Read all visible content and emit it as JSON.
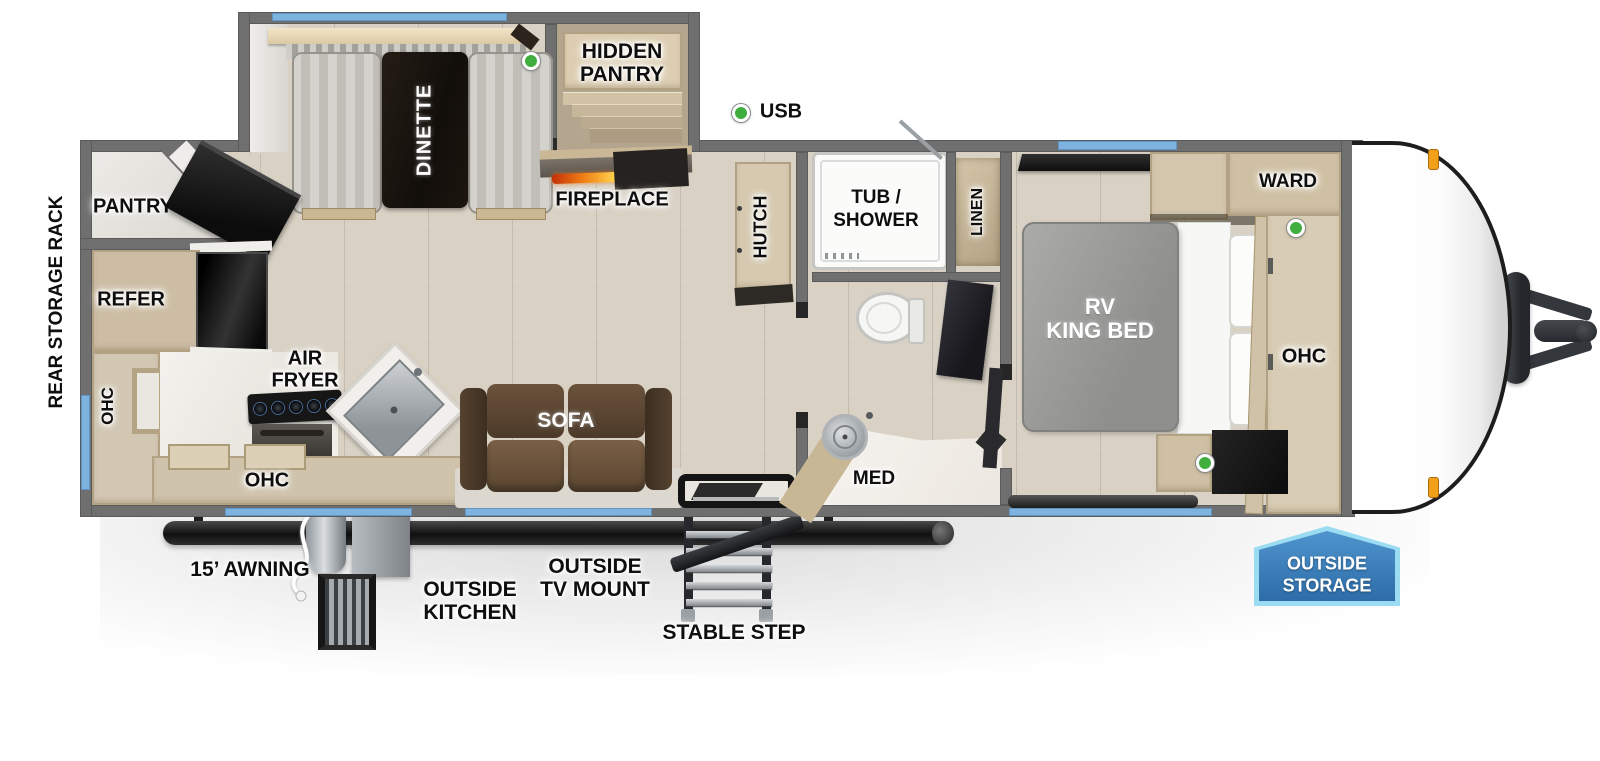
{
  "floorplan": {
    "interior_labels": {
      "hidden_pantry": [
        "HIDDEN",
        "PANTRY"
      ],
      "dinette": "DINETTE",
      "fireplace": "FIREPLACE",
      "pantry": "PANTRY",
      "refer": "REFER",
      "rear_storage_rack": "REAR STORAGE RACK",
      "ohc_rear": "OHC",
      "air_fryer": [
        "AIR",
        "FRYER"
      ],
      "ohc_kitchen": "OHC",
      "sofa": "SOFA",
      "hutch": "HUTCH",
      "tub_shower": [
        "TUB /",
        "SHOWER"
      ],
      "linen": "LINEN",
      "med": "MED",
      "rv_king_bed": [
        "RV",
        "KING BED"
      ],
      "ward": "WARD",
      "ohc_bedroom": "OHC"
    },
    "exterior_labels": {
      "awning": "15’ AWNING",
      "outside_kitchen": [
        "OUTSIDE",
        "KITCHEN"
      ],
      "outside_tv_mount": [
        "OUTSIDE",
        "TV MOUNT"
      ],
      "stable_step": "STABLE STEP"
    },
    "badge": {
      "line1": "OUTSIDE",
      "line2": "STORAGE"
    },
    "usb_legend": "USB",
    "icons": {
      "usb_port_dots": 3,
      "usb_legend_dot": "green-dot",
      "marker_lights": "orange-marker"
    },
    "colors": {
      "window_blue": "#7eb3e0",
      "usb_green": "#3fae3f",
      "wall_gray": "#6f6f6f",
      "badge_blue": "#3074b5",
      "badge_border": "#9bdcf3",
      "marker_orange": "#f2a01c",
      "sofa_brown": "#5d4937",
      "table_black": "#1a1510",
      "mattress_gray": "#9c9c9a"
    }
  }
}
